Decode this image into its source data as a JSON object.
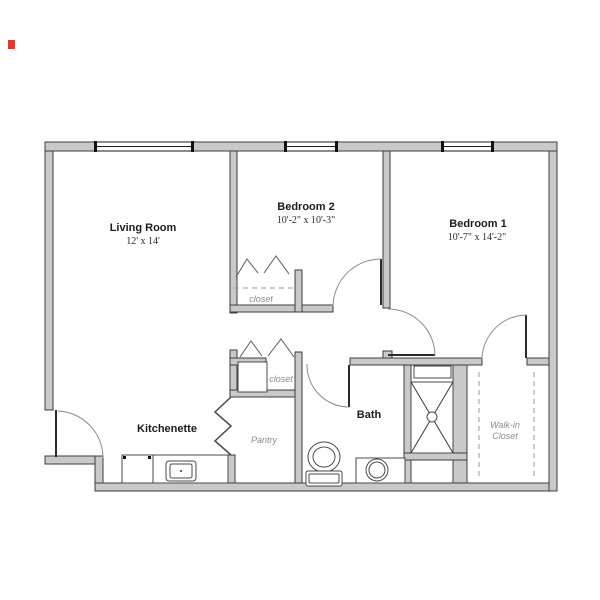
{
  "plan": {
    "title": "Apartment floor plan",
    "rooms": {
      "living": {
        "name": "Living Room",
        "dims": "12' x 14'"
      },
      "bedroom2": {
        "name": "Bedroom 2",
        "dims": "10'-2\" x 10'-3\""
      },
      "bedroom1": {
        "name": "Bedroom 1",
        "dims": "10'-7\" x 14'-2\""
      },
      "kitchenette": {
        "name": "Kitchenette"
      },
      "bath": {
        "name": "Bath"
      },
      "pantry": {
        "name": "Pantry"
      },
      "walkin": {
        "line1": "Walk-in",
        "line2": "Closet"
      },
      "closet_bedroom2": {
        "name": "closet"
      },
      "closet_hall": {
        "name": "closet"
      }
    },
    "colors": {
      "wall_fill": "#c9c9c9",
      "wall_stroke": "#3d3d3d",
      "background": "#ffffff",
      "room_label": "#1c1c1c",
      "muted_label": "#8b8b8b",
      "artifact_mark": "#e03a2f"
    }
  }
}
